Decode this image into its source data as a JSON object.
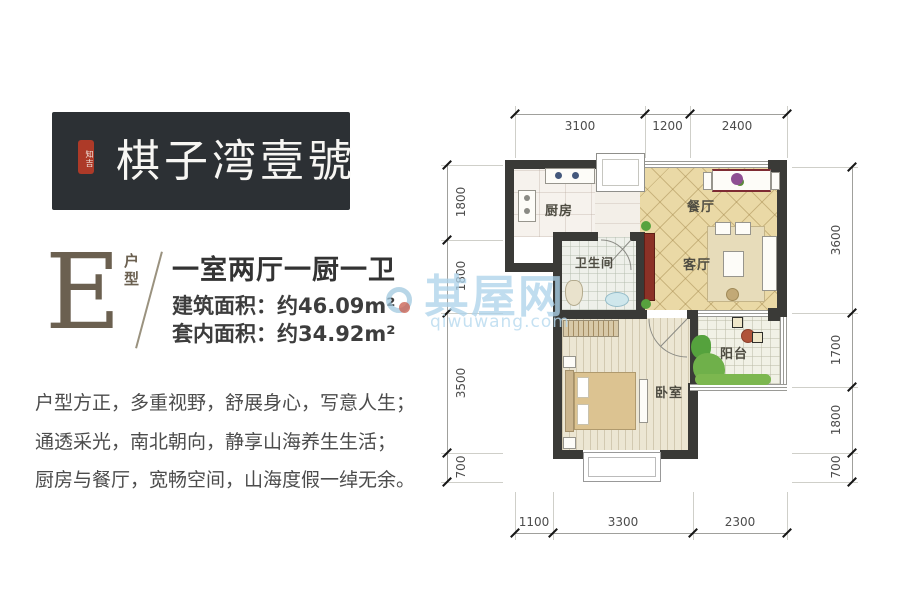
{
  "logo": {
    "seal": "知吉",
    "brand": "棋子湾壹號"
  },
  "unit": {
    "letter": "E",
    "type_label": "户型",
    "title": "一室两厅一厨一卫",
    "area1": "建筑面积：约46.09m²",
    "area2": "套内面积：约34.92m²"
  },
  "desc": {
    "lines": [
      "户型方正，多重视野，舒展身心，写意人生；",
      "通透采光，南北朝向，静享山海养生生活；",
      "厨房与餐厅，宽畅空间，山海度假一绰无余。"
    ]
  },
  "plan": {
    "rooms": {
      "kitchen": "厨房",
      "dining": "餐厅",
      "bathroom": "卫生间",
      "living": "客厅",
      "bedroom": "卧室",
      "balcony": "阳台"
    },
    "dims": {
      "top": [
        "3100",
        "1200",
        "2400"
      ],
      "bottom": [
        "1100",
        "3300",
        "2300"
      ],
      "left": [
        "1800",
        "1800",
        "3500",
        "700"
      ],
      "right": [
        "3600",
        "1700",
        "1800",
        "700"
      ]
    }
  },
  "watermark": {
    "name": "其屋网",
    "domain": "qiwuwang.com"
  },
  "colors": {
    "wall": "#3a3a37",
    "brand_bg": "#2c3034",
    "seal_red": "#ad3a28",
    "accent_brown": "#6b6050",
    "tile_beige": "#ead9a6",
    "watermark_blue": "#add3ea"
  }
}
